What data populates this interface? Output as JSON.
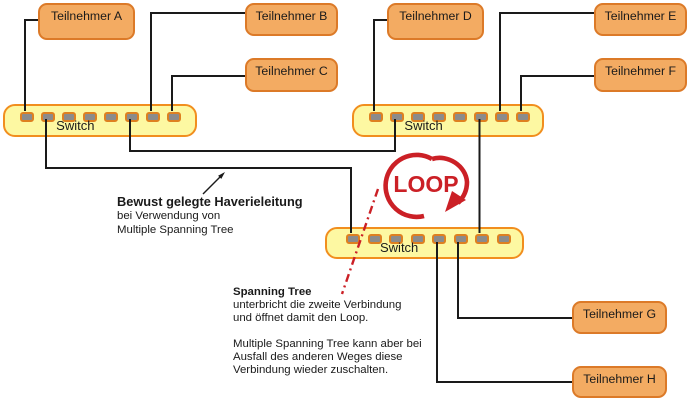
{
  "diagram": {
    "participants": [
      {
        "label": "Teilnehmer A"
      },
      {
        "label": "Teilnehmer B"
      },
      {
        "label": "Teilnehmer C"
      },
      {
        "label": "Teilnehmer D"
      },
      {
        "label": "Teilnehmer E"
      },
      {
        "label": "Teilnehmer F"
      },
      {
        "label": "Teilnehmer G"
      },
      {
        "label": "Teilnehmer H"
      }
    ],
    "switches": [
      {
        "label": "Switch"
      },
      {
        "label": "Switch"
      },
      {
        "label": "Switch"
      }
    ],
    "loop": {
      "label": "LOOP"
    },
    "annotations": {
      "haverie": {
        "title": "Bewust gelegte Haverieleitung",
        "line1": "bei Verwendung von",
        "line2": "Multiple Spanning Tree"
      },
      "spanning": {
        "title": "Spanning Tree",
        "line1": "unterbricht die zweite Verbindung",
        "line2": "und öffnet damit den Loop.",
        "line3": "Multiple Spanning Tree kann aber bei",
        "line4": "Ausfall des anderen Weges diese",
        "line5": "Verbindung wieder zuschalten."
      }
    },
    "colors": {
      "participant-fill": "#F3AB62",
      "participant-border": "#DC7A28",
      "switch-fill": "#FDF8A2",
      "switch-border": "#F18E1E",
      "port-fill": "#8B8B8B",
      "port-border": "#DE8020",
      "wire": "#1A1A1A",
      "accent-red": "#CB2026"
    }
  }
}
